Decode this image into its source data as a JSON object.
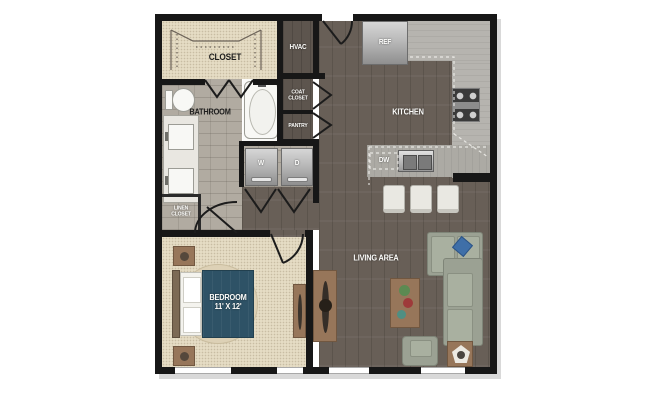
{
  "floor_plan": {
    "labels": {
      "closet": "CLOSET",
      "hvac": "HVAC",
      "bathroom": "BATHROOM",
      "coat_closet": [
        "COAT",
        "CLOSET"
      ],
      "pantry": "PANTRY",
      "kitchen": "KITCHEN",
      "linen_closet": [
        "LINEN",
        "CLOSET"
      ],
      "bedroom": [
        "BEDROOM",
        "11' X 12'"
      ],
      "living_area": "LIVING AREA",
      "ref": "REF",
      "washer": "W",
      "dryer": "D",
      "dishwasher": "DW"
    },
    "colors": {
      "wall": "#171717",
      "carpet": "#e5dcc4",
      "tile": "#b1aba1",
      "wood_floor": "#685f57",
      "counter": "#b6b4af",
      "bed_blanket": "#2e5266",
      "sofa": "#9ba193",
      "wood_furniture": "#97765a",
      "accent_pillow": "#3f6fa8"
    }
  }
}
